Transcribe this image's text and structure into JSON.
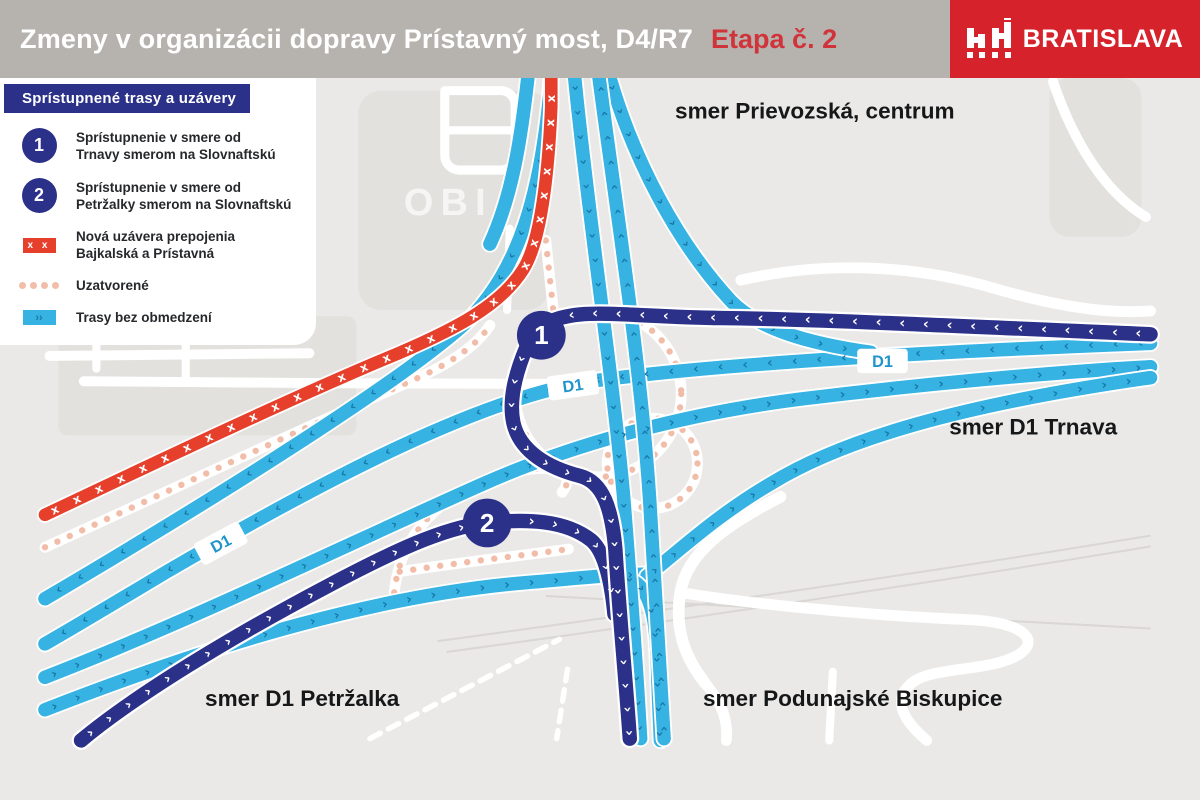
{
  "header": {
    "title": "Zmeny v organizácii dopravy Prístavný most, D4/R7",
    "stage": "Etapa č. 2",
    "logo": {
      "text": "BRATISLAVA"
    }
  },
  "legend": {
    "title": "Sprístupnené trasy a uzávery",
    "items": [
      {
        "icon": "route-1-circle",
        "number": "1",
        "line1": "Sprístupnenie v smere od",
        "line2": "Trnavy smerom na Slovnaftskú"
      },
      {
        "icon": "route-2-circle",
        "number": "2",
        "line1": "Sprístupnenie v smere od",
        "line2": "Petržalky smerom na Slovnaftskú"
      },
      {
        "icon": "closure-x-swatch",
        "swatch_marks": "x x",
        "line1": "Nová uzávera prepojenia",
        "line2": "Bajkalská a Prístavná"
      },
      {
        "icon": "closed-dotted-swatch",
        "line1": "Uzatvorené",
        "line2": ""
      },
      {
        "icon": "open-route-swatch",
        "swatch_marks": "››",
        "line1": "Trasy bez obmedzení",
        "line2": ""
      }
    ]
  },
  "map": {
    "labels": {
      "north": "smer Prievozská, centrum",
      "east": "smer D1 Trnava",
      "southwest": "smer D1 Petržalka",
      "southeast": "smer Podunajské Biskupice",
      "store": "OBI"
    },
    "badges": {
      "d1": "D1"
    },
    "markers": {
      "route1": "1",
      "route2": "2"
    }
  },
  "colors": {
    "header_bg": "#b6b2ae",
    "logo_red": "#d6222b",
    "stage_red": "#d0343a",
    "navy": "#2b3088",
    "light_blue": "#36b2e3",
    "arrow_blue": "#1778a6",
    "closure_red": "#e6402c",
    "dotted_salmon": "#f1bda9",
    "map_bg": "#eae9e7",
    "building_gray": "#e3e1dd",
    "road_white": "#ffffff"
  }
}
